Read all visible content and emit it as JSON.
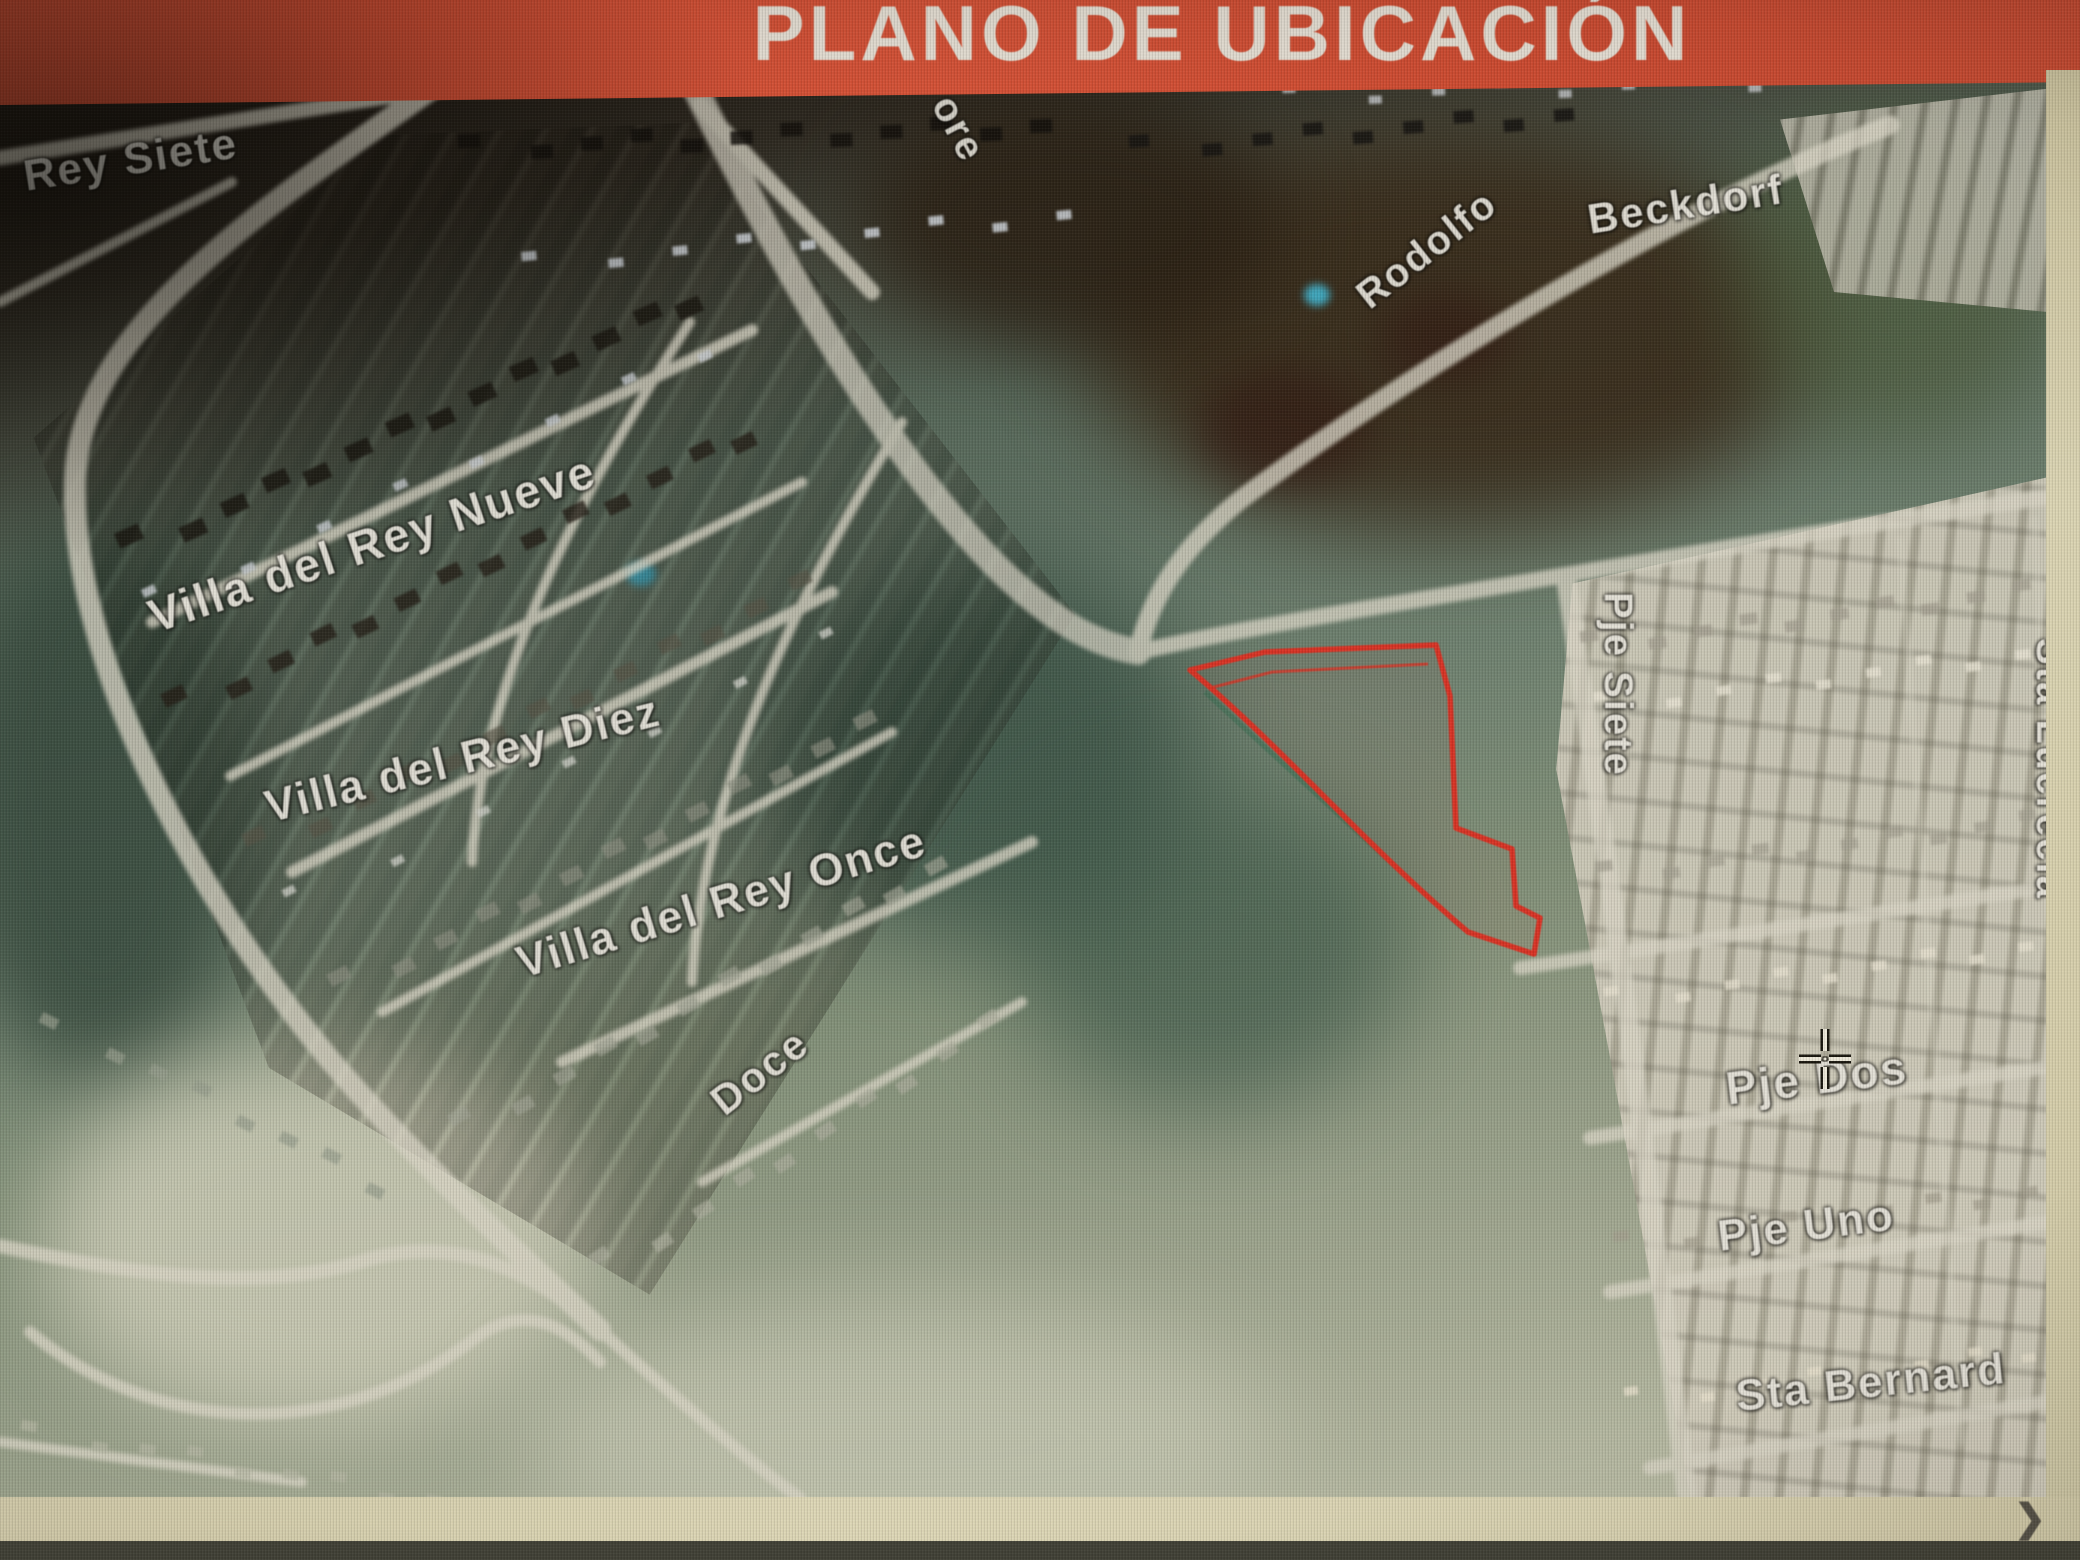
{
  "banner": {
    "title": "PLANO DE UBICACIÓN",
    "bg_color": "#d94d34",
    "text_color": "#f2ece3"
  },
  "map": {
    "type": "satellite-location-plan",
    "parcel_outline_color": "#e03226",
    "label_color": "#eceae4",
    "cursor_icon": "crosshair",
    "street_labels": [
      {
        "id": "rey-siete",
        "text": "Rey Siete"
      },
      {
        "id": "ore-fragment",
        "text": "ore"
      },
      {
        "id": "rodolfo",
        "text": "Rodolfo"
      },
      {
        "id": "beckdorf",
        "text": "Beckdorf"
      },
      {
        "id": "villa-del-rey-nueve",
        "text": "Villa del Rey Nueve"
      },
      {
        "id": "villa-del-rey-diez",
        "text": "Villa del Rey Diez"
      },
      {
        "id": "villa-del-rey-once",
        "text": "Villa del Rey Once"
      },
      {
        "id": "doce",
        "text": "Doce"
      },
      {
        "id": "pje-siete",
        "text": "Pje Siete"
      },
      {
        "id": "sta-lucrecia",
        "text": "Sta Lucrecia"
      },
      {
        "id": "pje-dos",
        "text": "Pje Dos"
      },
      {
        "id": "pje-uno",
        "text": "Pje Uno"
      },
      {
        "id": "sta-bernard",
        "text": "Sta Bernard"
      }
    ]
  },
  "scrollbar": {
    "arrow_glyph": "❯"
  }
}
